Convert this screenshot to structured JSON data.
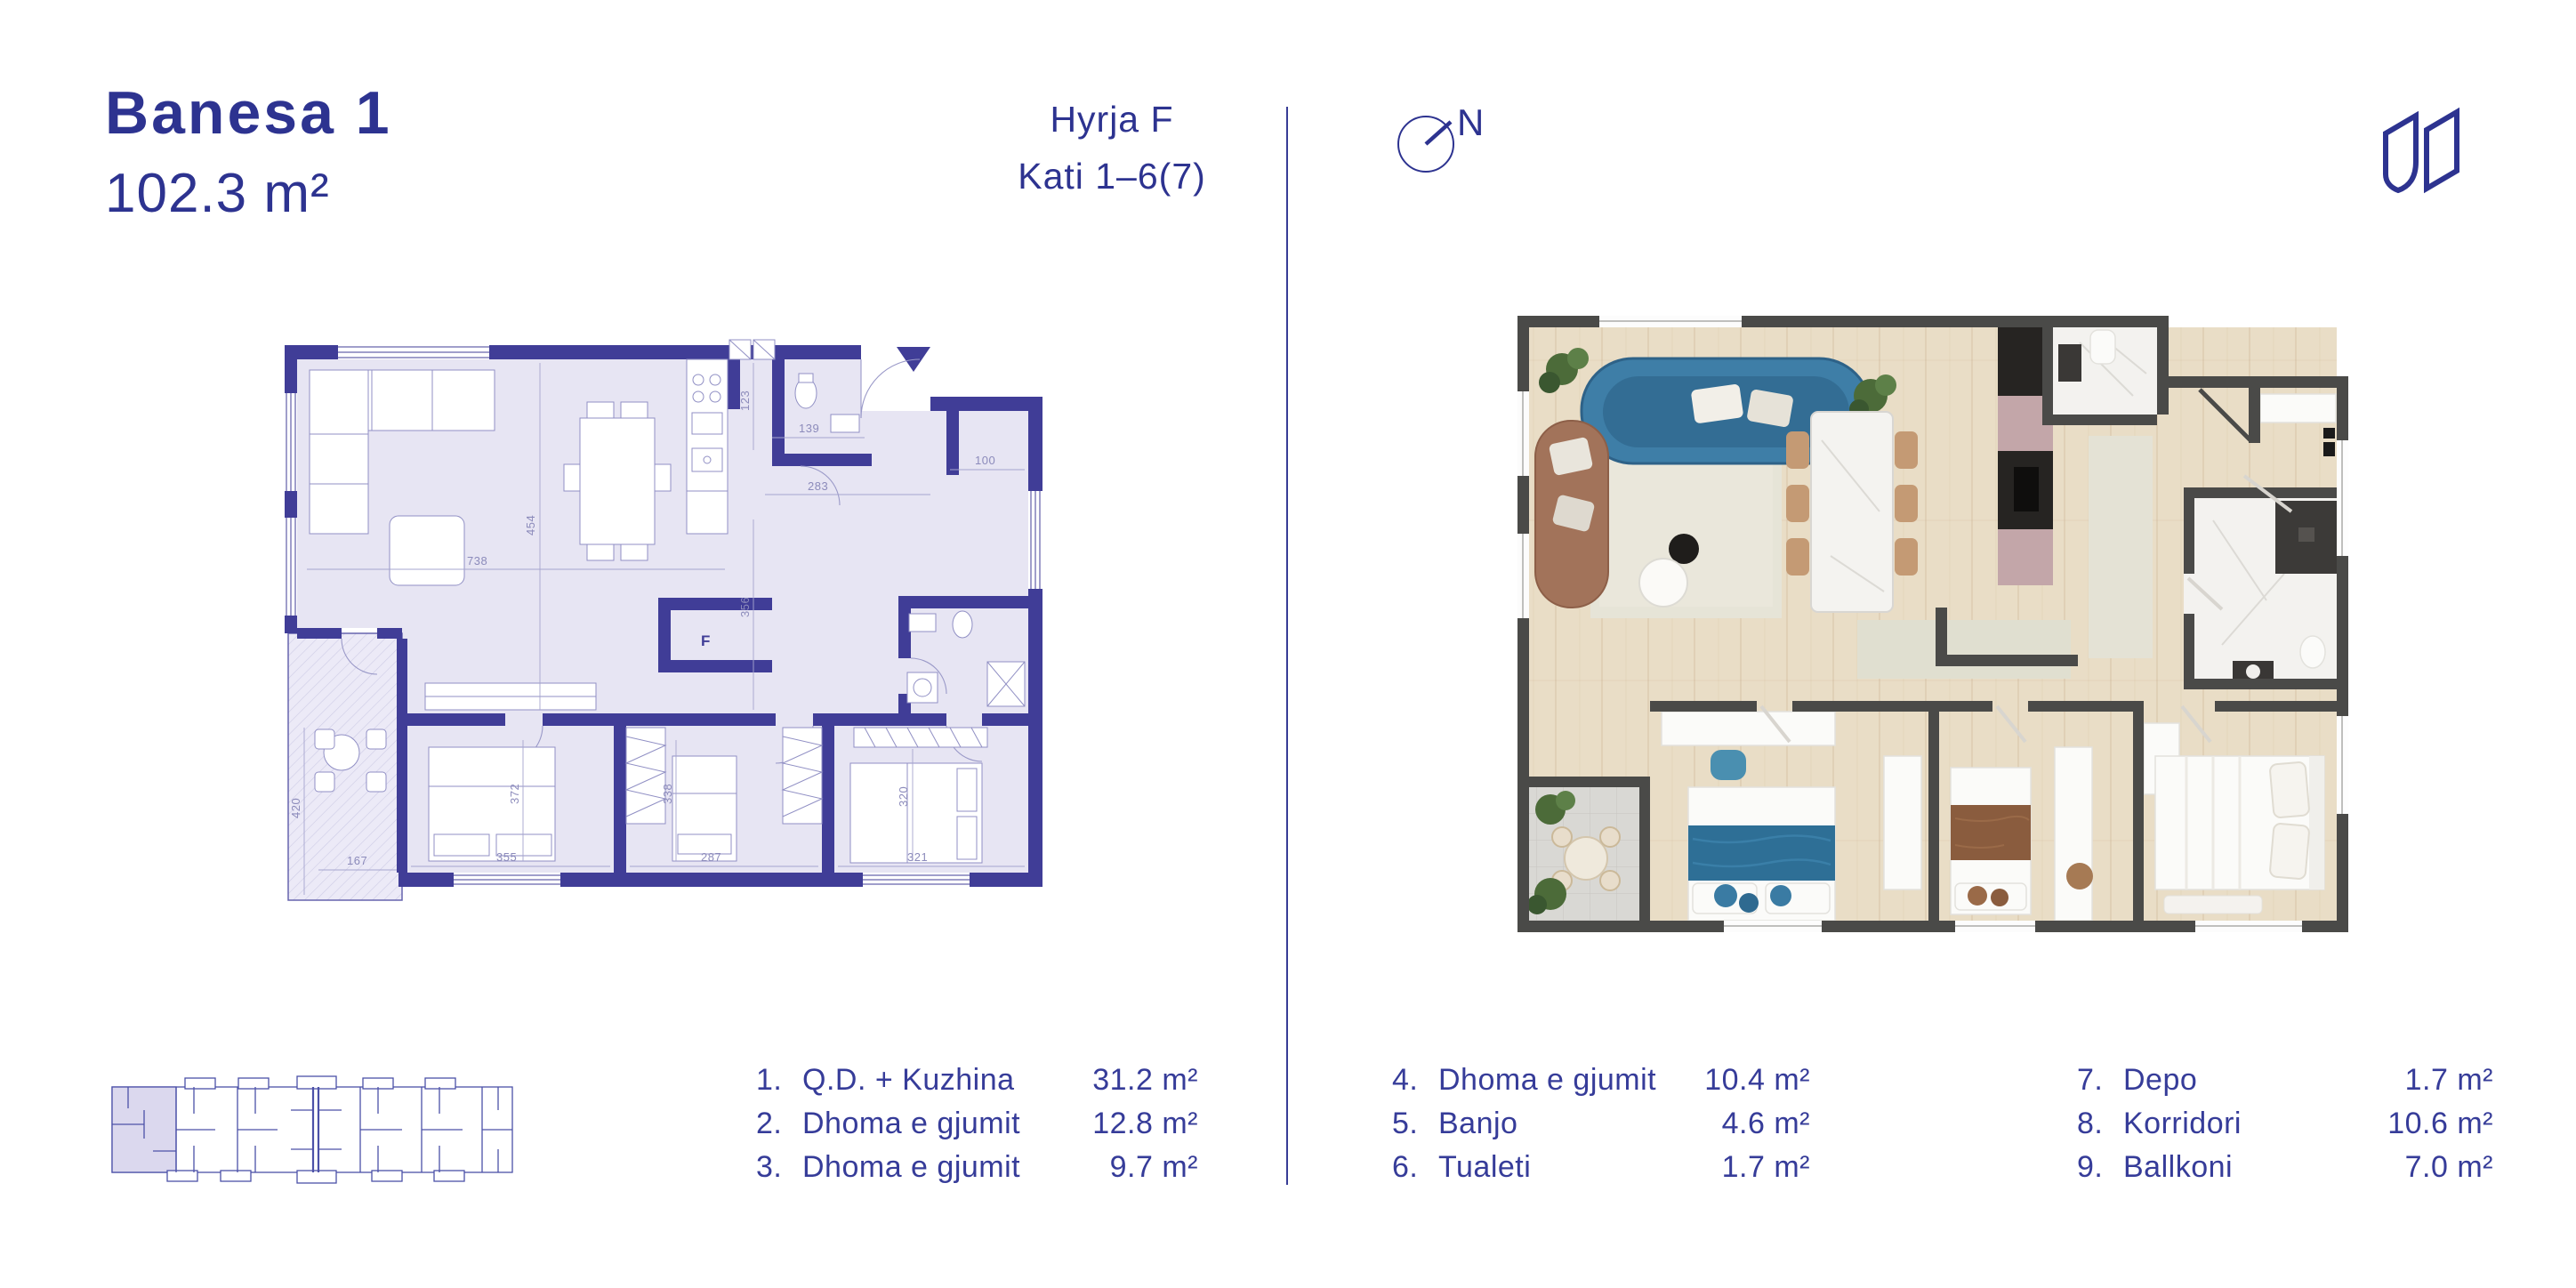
{
  "header": {
    "title": "Banesa 1",
    "area": "102.3 m²",
    "entrance": "Hyrja F",
    "floor_range": "Kati 1–6(7)"
  },
  "compass": {
    "north_label": "N"
  },
  "left_plan": {
    "fridge_label": "F",
    "dimensions": {
      "d123": "123",
      "d139": "139",
      "d283": "283",
      "d100": "100",
      "d454": "454",
      "d738": "738",
      "d356": "356",
      "d420": "420",
      "d167": "167",
      "d355": "355",
      "d372": "372",
      "d338": "338",
      "d287": "287",
      "d321": "321",
      "d320": "320"
    }
  },
  "legend": {
    "columns": [
      {
        "items": [
          {
            "num": "1.",
            "label": "Q.D. + Kuzhina",
            "area": "31.2 m²"
          },
          {
            "num": "2.",
            "label": "Dhoma e gjumit",
            "area": "12.8 m²"
          },
          {
            "num": "3.",
            "label": "Dhoma e gjumit",
            "area": "9.7 m²"
          }
        ]
      },
      {
        "items": [
          {
            "num": "4.",
            "label": "Dhoma e gjumit",
            "area": "10.4 m²"
          },
          {
            "num": "5.",
            "label": "Banjo",
            "area": "4.6 m²"
          },
          {
            "num": "6.",
            "label": "Tualeti",
            "area": "1.7 m²"
          }
        ]
      },
      {
        "items": [
          {
            "num": "7.",
            "label": "Depo",
            "area": "1.7 m²"
          },
          {
            "num": "8.",
            "label": "Korridori",
            "area": "10.6 m²"
          },
          {
            "num": "9.",
            "label": "Ballkoni",
            "area": "7.0 m²"
          }
        ]
      }
    ]
  },
  "colors": {
    "brand_indigo": "#2d3390",
    "plan_wall": "#403d97",
    "plan_floor": "#e7e5f3",
    "plan_dim_text": "#8c8bbb",
    "render_wall": "#4a4a48",
    "render_floor": "#e9ddc6",
    "render_sofa_blue": "#3e7ea7",
    "render_sofa_brown": "#a2735a",
    "render_bed_blue": "#2e6f96",
    "render_marble": "#f3f2ef",
    "render_balcony_tile": "#d9d8d4",
    "plant_green": "#4c6b39"
  }
}
